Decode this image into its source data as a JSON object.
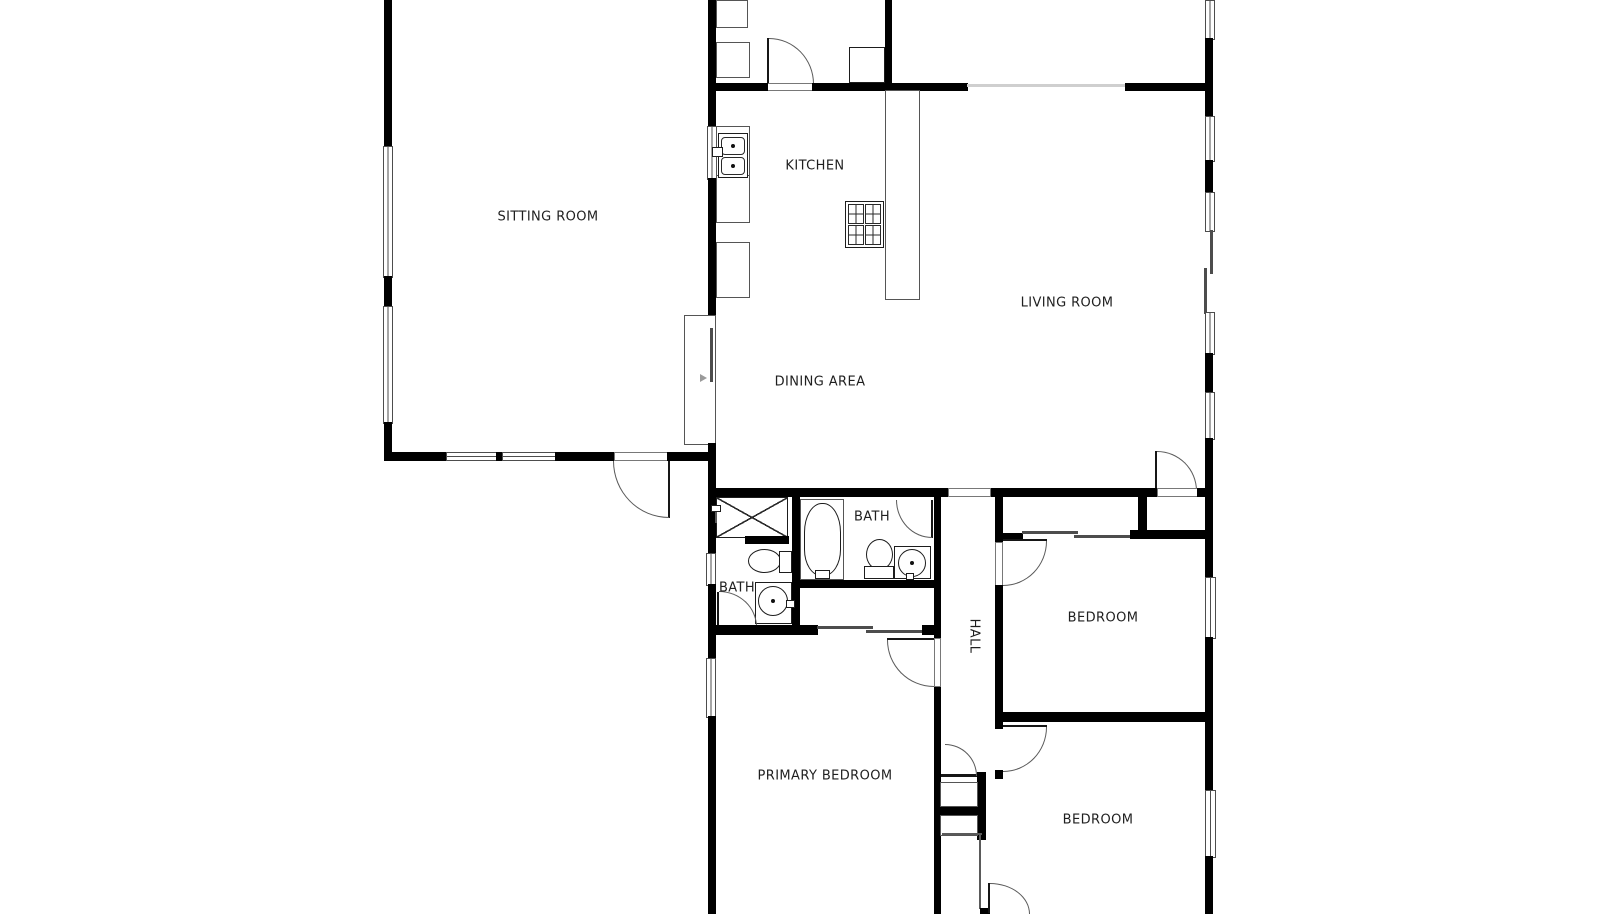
{
  "figure": {
    "type": "floor-plan"
  },
  "colors": {
    "wall": "#000000",
    "line": "#4d4d4d",
    "door_arc": "#5a5a5a",
    "open_boundary": "#cfcfcf",
    "background": "#ffffff",
    "text": "#1f1f1f"
  },
  "rooms": {
    "sitting_room": {
      "label": "SITTING ROOM"
    },
    "kitchen": {
      "label": "KITCHEN"
    },
    "living_room": {
      "label": "LIVING ROOM"
    },
    "dining_area": {
      "label": "DINING AREA"
    },
    "bath_main": {
      "label": "BATH"
    },
    "bath_ensuite": {
      "label": "BATH"
    },
    "hall": {
      "label": "HALL"
    },
    "bedroom_east": {
      "label": "BEDROOM"
    },
    "bedroom_south": {
      "label": "BEDROOM"
    },
    "primary_bedroom": {
      "label": "PRIMARY BEDROOM"
    }
  },
  "fixtures": {
    "kitchen": [
      "double-basin-sink",
      "counter",
      "base-cabinet",
      "range-stove",
      "island"
    ],
    "utility": [
      "cabinet",
      "cabinet",
      "water-heater"
    ],
    "bath_main": [
      "bathtub",
      "toilet",
      "vanity-sink"
    ],
    "bath_ensuite": [
      "shower",
      "shower-valve",
      "toilet",
      "vanity-sink"
    ],
    "hall_closet": [
      "shelf",
      "shelf"
    ]
  }
}
